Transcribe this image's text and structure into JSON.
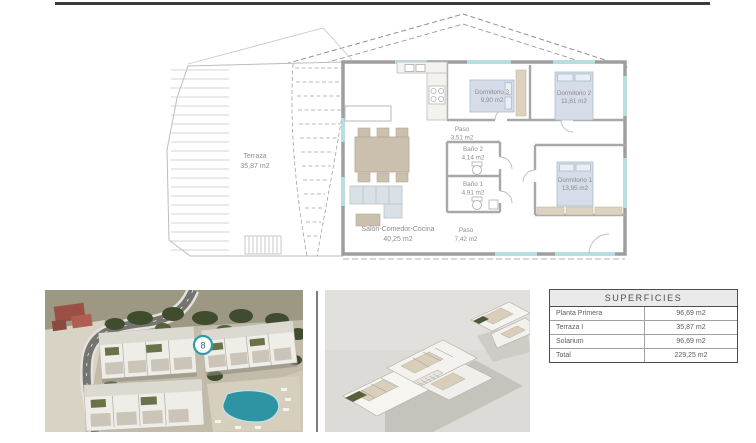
{
  "page": {
    "top_rule_color": "#3a3a3c"
  },
  "floor_plan": {
    "rooms": {
      "terraza": {
        "name": "Terraza",
        "area": "35,87 m2"
      },
      "salon": {
        "name": "Salón-Comedor-Cocina",
        "area": "40,25 m2"
      },
      "paso_upper": {
        "name": "Paso",
        "area": "3,51 m2"
      },
      "bano2": {
        "name": "Baño 2",
        "area": "4,14 m2"
      },
      "bano1": {
        "name": "Baño 1",
        "area": "4,91 m2"
      },
      "paso_lower": {
        "name": "Paso",
        "area": "7,42 m2"
      },
      "dormitorio3": {
        "name": "Dormitorio 3",
        "area": "9,90 m2"
      },
      "dormitorio2": {
        "name": "Dormitorio 2",
        "area": "11,61 m2"
      },
      "dormitorio1": {
        "name": "Dormitorio 1",
        "area": "13,95 m2"
      }
    }
  },
  "aerial_photo": {
    "marker_label": "8",
    "marker_color": "#2b9fa9"
  },
  "surfaces_table": {
    "title": "SUPERFICIES",
    "rows": [
      {
        "label": "Planta Primera",
        "value": "96,69 m2"
      },
      {
        "label": "Terraza I",
        "value": "35,87 m2"
      },
      {
        "label": "Solarium",
        "value": "96,69 m2"
      },
      {
        "label": "Total",
        "value": "229,25 m2"
      }
    ]
  }
}
